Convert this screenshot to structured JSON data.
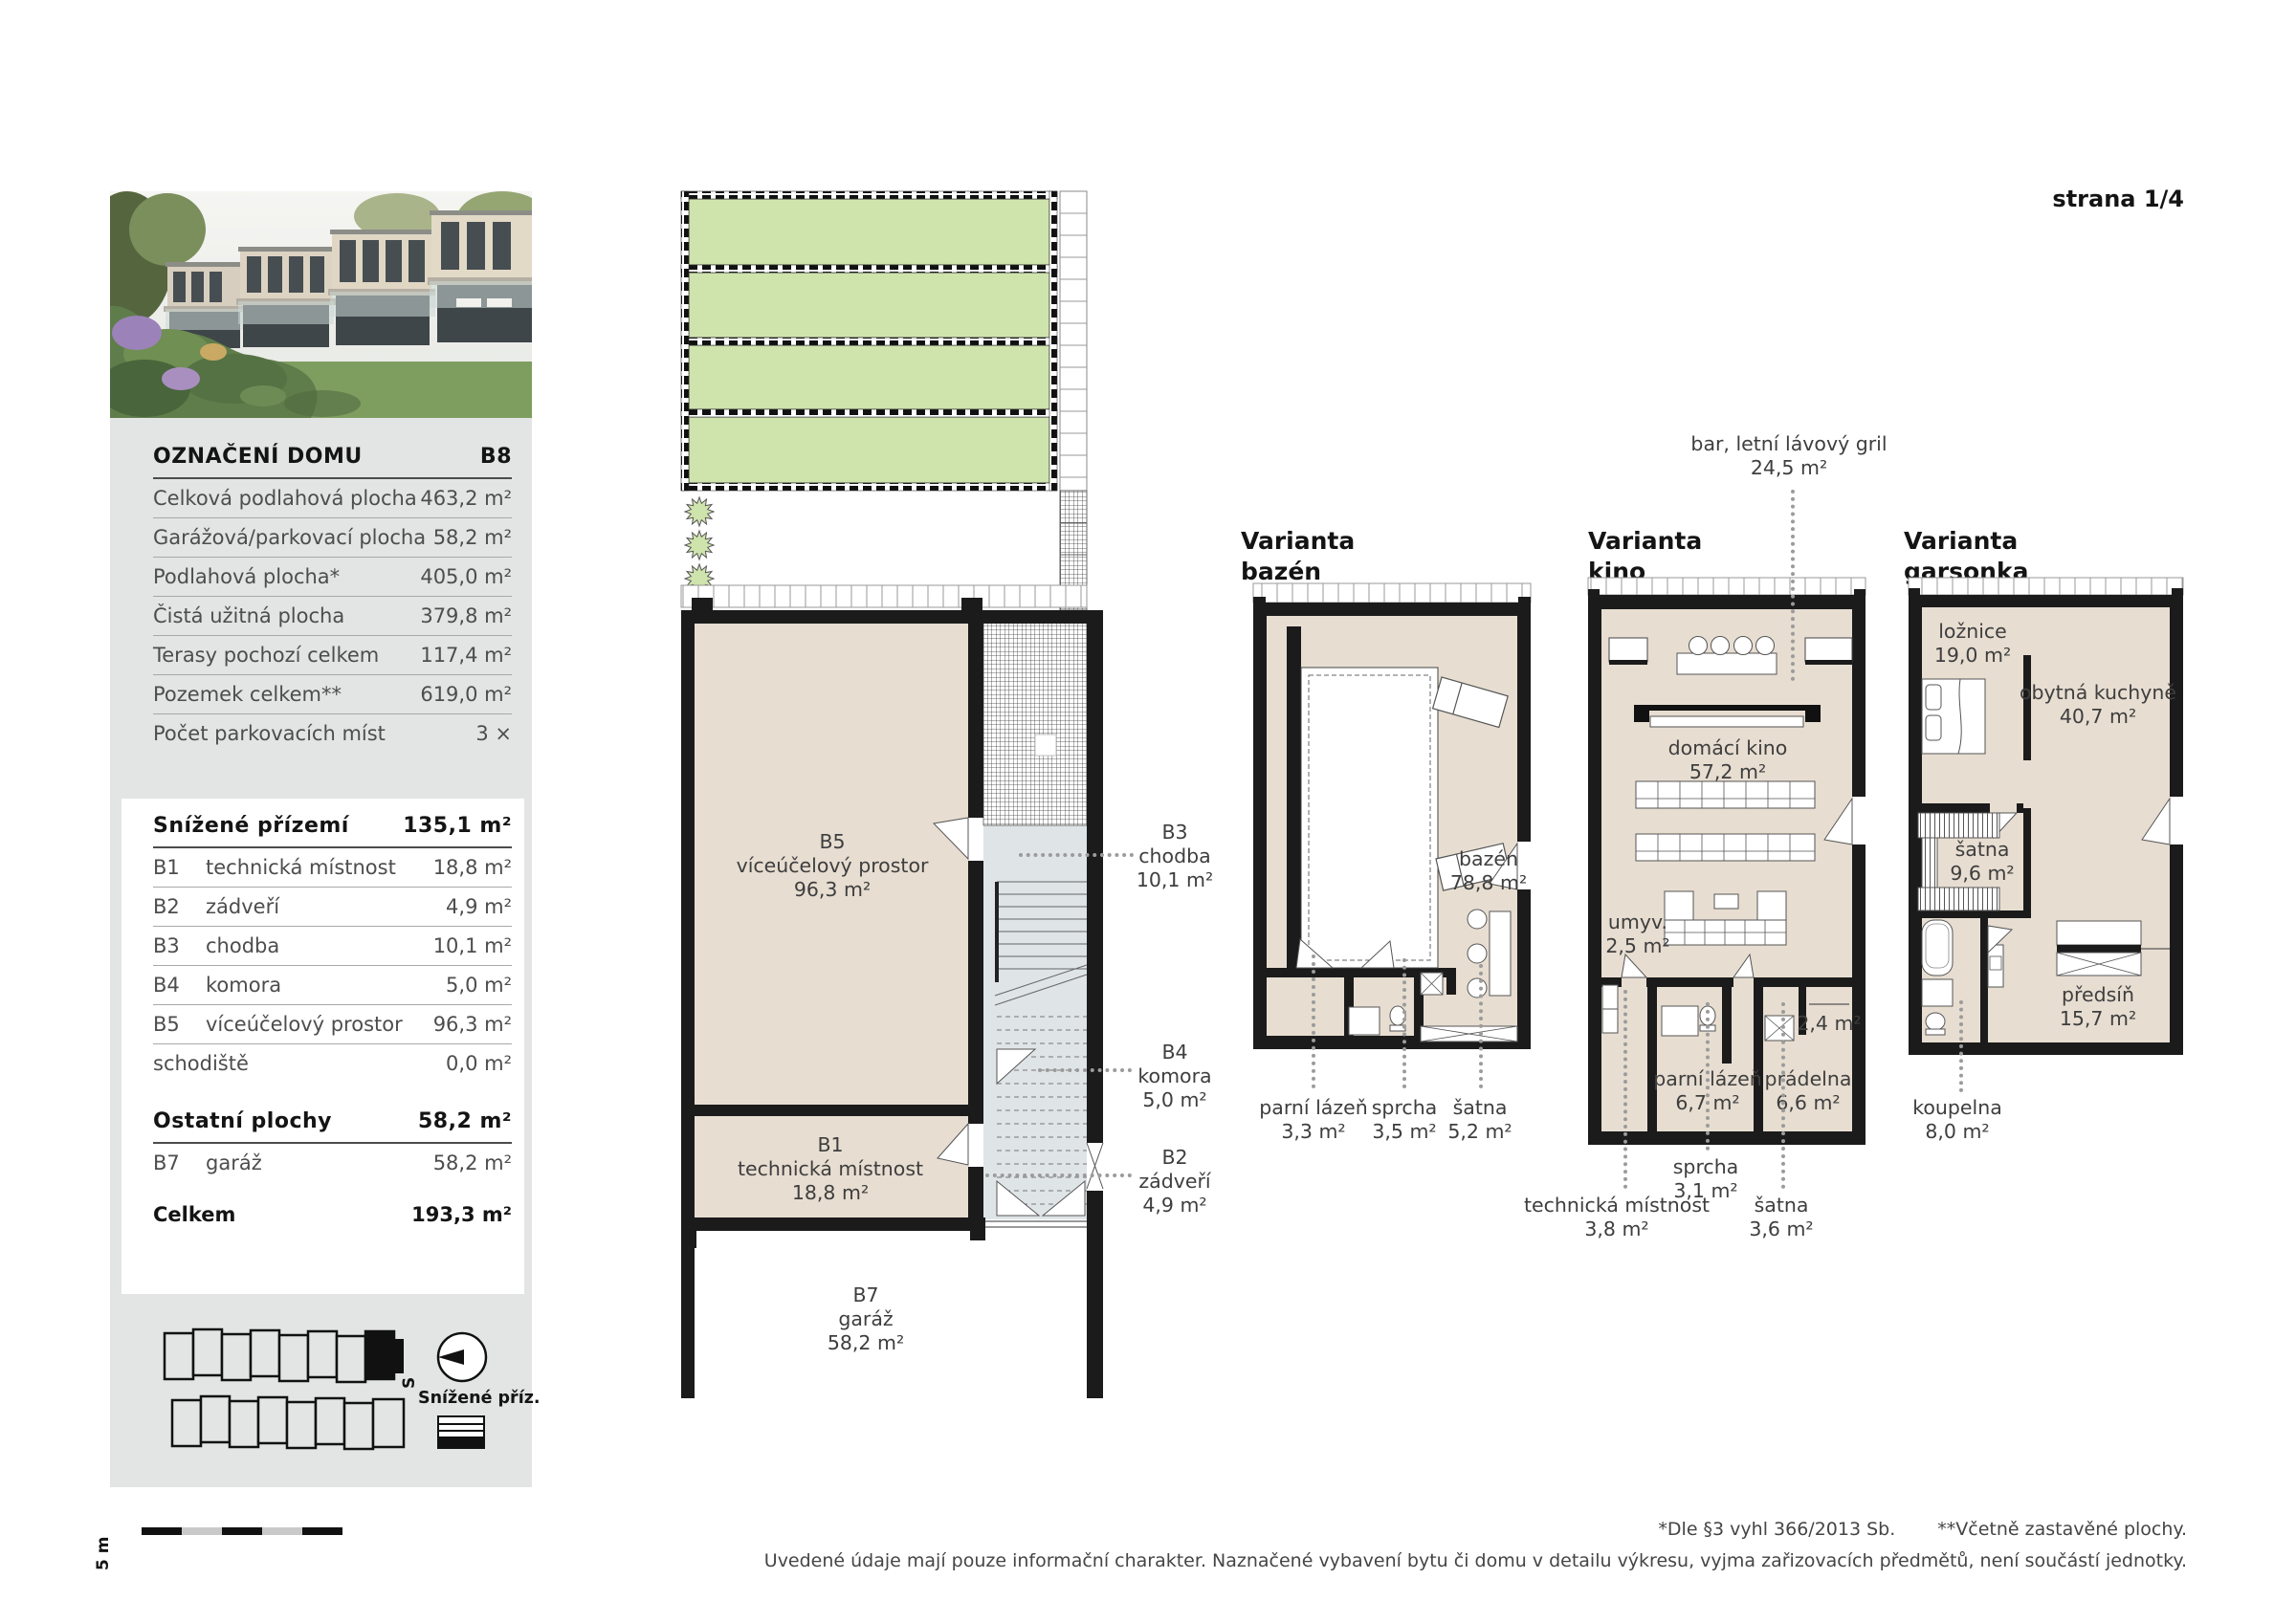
{
  "page": {
    "title": "strana 1/4",
    "footnote_a": "*Dle §3 vyhl 366/2013 Sb.",
    "footnote_b": "**Včetně zastavěné plochy.",
    "disclaimer": "Uvedené údaje mají pouze informační charakter. Naznačené vybavení bytu či domu v detailu výkresu, vyjma zařizovacích předmětů, není součástí jednotky."
  },
  "palette": {
    "panel_gray": "#e3e4e4",
    "garden_green": "#cfe3ad",
    "room_beige": "#e7ddd1",
    "stair_gray": "#dfe4e7",
    "wall_black": "#1b1b1b",
    "leader_gray": "#9b9b9b"
  },
  "summary": {
    "title": "OZNAČENÍ DOMU",
    "house_id": "B8",
    "rows": [
      {
        "label": "Celková podlahová plocha",
        "value": "463,2 m²"
      },
      {
        "label": "Garážová/parkovací plocha",
        "value": "58,2 m²"
      },
      {
        "label": "Podlahová plocha*",
        "value": "405,0 m²"
      },
      {
        "label": "Čistá užitná plocha",
        "value": "379,8 m²"
      },
      {
        "label": "Terasy pochozí celkem",
        "value": "117,4 m²"
      },
      {
        "label": "Pozemek celkem**",
        "value": "619,0 m²"
      },
      {
        "label": "Počet parkovacích míst",
        "value": "3 ×"
      }
    ]
  },
  "ground_floor": {
    "title": "Snížené přízemí",
    "total": "135,1 m²",
    "rows": [
      {
        "code": "B1",
        "label": "technická místnost",
        "value": "18,8 m²"
      },
      {
        "code": "B2",
        "label": "zádveří",
        "value": "4,9 m²"
      },
      {
        "code": "B3",
        "label": "chodba",
        "value": "10,1 m²"
      },
      {
        "code": "B4",
        "label": "komora",
        "value": "5,0 m²"
      },
      {
        "code": "B5",
        "label": "víceúčelový prostor",
        "value": "96,3 m²"
      },
      {
        "code": "",
        "label": "schodiště",
        "value": "0,0 m²"
      }
    ]
  },
  "other_areas": {
    "title": "Ostatní plochy",
    "total": "58,2 m²",
    "rows": [
      {
        "code": "B7",
        "label": "garáž",
        "value": "58,2 m²"
      }
    ]
  },
  "grand_total": {
    "label": "Celkem",
    "value": "193,3 m²"
  },
  "site": {
    "compass_label": "S",
    "legend_title": "Snížené příz.",
    "scale_label": "5 m"
  },
  "main_plan": {
    "b5": {
      "code": "B5",
      "name": "víceúčelový prostor",
      "area": "96,3 m²"
    },
    "b1": {
      "code": "B1",
      "name": "technická místnost",
      "area": "18,8 m²"
    },
    "b7": {
      "code": "B7",
      "name": "garáž",
      "area": "58,2 m²"
    },
    "b3": {
      "code": "B3",
      "name": "chodba",
      "area": "10,1 m²"
    },
    "b4": {
      "code": "B4",
      "name": "komora",
      "area": "5,0 m²"
    },
    "b2": {
      "code": "B2",
      "name": "zádveří",
      "area": "4,9 m²"
    }
  },
  "variant_pool": {
    "title_line1": "Varianta",
    "title_line2": "bazén",
    "rooms": {
      "pool": {
        "name": "bazén",
        "area": "78,8 m²"
      },
      "steam": {
        "name": "parní lázeň",
        "area": "3,3 m²"
      },
      "shower": {
        "name": "sprcha",
        "area": "3,5 m²"
      },
      "wardrobe": {
        "name": "šatna",
        "area": "5,2 m²"
      }
    }
  },
  "variant_cinema": {
    "title_line1": "Varianta",
    "title_line2": "kino",
    "rooms": {
      "bar": {
        "name": "bar, letní lávový gril",
        "area": "24,5 m²"
      },
      "cinema": {
        "name": "domácí kino",
        "area": "57,2 m²"
      },
      "wash": {
        "name": "umyv.",
        "area": "2,5 m²"
      },
      "steam": {
        "name": "parní lázeň",
        "area": "6,7 m²"
      },
      "laundry": {
        "name": "prádelna",
        "area": "6,6 m²"
      },
      "niche": {
        "area": "2,4 m²"
      },
      "tech": {
        "name": "technická místnost",
        "area": "3,8 m²"
      },
      "shower": {
        "name": "sprcha",
        "area": "3,1 m²"
      },
      "wardrobe": {
        "name": "šatna",
        "area": "3,6 m²"
      }
    }
  },
  "variant_studio": {
    "title_line1": "Varianta",
    "title_line2": "garsonka",
    "rooms": {
      "bedroom": {
        "name": "ložnice",
        "area": "19,0 m²"
      },
      "kitchen": {
        "name": "obytná kuchyně",
        "area": "40,7 m²"
      },
      "wardrobe": {
        "name": "šatna",
        "area": "9,6 m²"
      },
      "hall": {
        "name": "předsíň",
        "area": "15,7 m²"
      },
      "bath": {
        "name": "koupelna",
        "area": "8,0 m²"
      }
    }
  }
}
